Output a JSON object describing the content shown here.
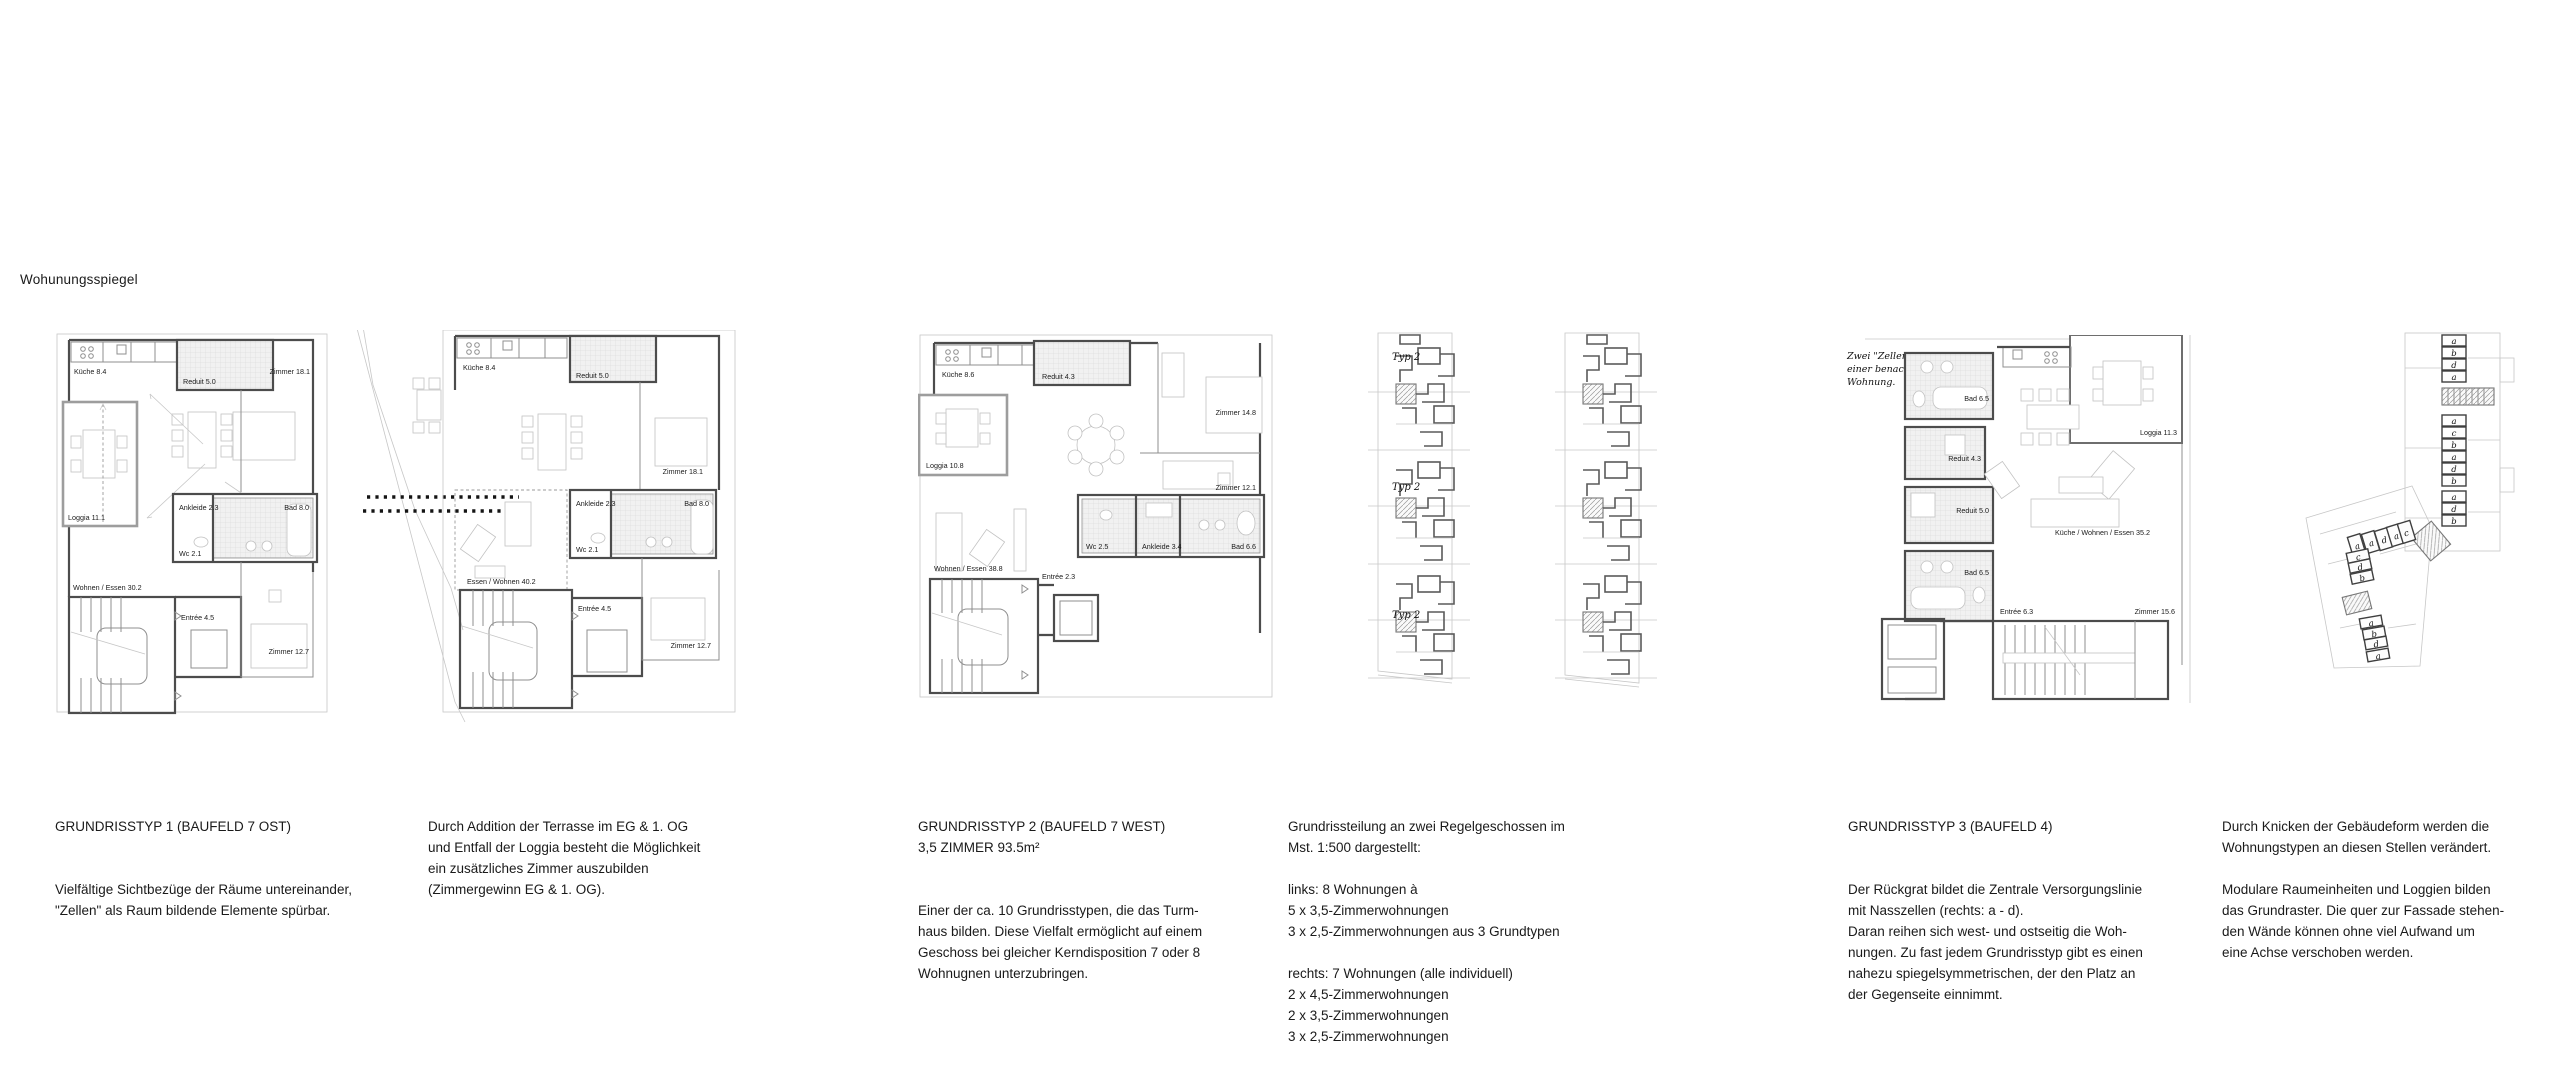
{
  "page": {
    "sheet_label": "Wohunungsspiegel"
  },
  "plans": {
    "plan1": {
      "rooms": {
        "kueche": "Küche 8.4",
        "reduit": "Reduit 5.0",
        "zimmer1": "Zimmer 18.1",
        "loggia": "Loggia 11.1",
        "ankleide": "Ankleide 2.3",
        "bad": "Bad 8.0",
        "wc": "Wc 2.1",
        "wohnen": "Wohnen / Essen 30.2",
        "entree": "Entrée 4.5",
        "zimmer2": "Zimmer 12.7"
      }
    },
    "plan2": {
      "rooms": {
        "kueche": "Küche 8.4",
        "reduit": "Reduit 5.0",
        "zimmer1": "Zimmer 18.1",
        "ankleide": "Ankleide 2.3",
        "bad": "Bad 8.0",
        "wc": "Wc 2.1",
        "wohnen": "Essen / Wohnen 40.2",
        "entree": "Entrée 4.5",
        "zimmer2": "Zimmer 12.7"
      }
    },
    "plan3": {
      "rooms": {
        "kueche": "Küche 8.6",
        "reduit": "Reduit 4.3",
        "zimmer1": "Zimmer 14.8",
        "loggia": "Loggia 10.8",
        "zimmer2": "Zimmer 12.1",
        "wc": "Wc 2.5",
        "ankleide": "Ankleide 3.4",
        "bad": "Bad 6.6",
        "wohnen": "Wohnen / Essen 38.8",
        "entree": "Entrée 2.3"
      }
    },
    "towers": {
      "typ_label": "Typ 2"
    },
    "plan4": {
      "note": "Zwei \"Zellen\"\neiner benachbarten\nWohnung.",
      "rooms": {
        "bad1": "Bad 6.5",
        "reduit1": "Reduit 4.3",
        "reduit2": "Reduit 5.0",
        "loggia": "Loggia 11.3",
        "kueche": "Küche / Wohnen / Essen 35.2",
        "bad2": "Bad 6.5",
        "entree": "Entrée 6.3",
        "zimmer": "Zimmer 15.6"
      }
    },
    "plan5": {
      "cells": [
        "a",
        "b",
        "d",
        "a",
        "a",
        "c",
        "b",
        "a",
        "d",
        "b",
        "a",
        "d",
        "b",
        "a",
        "a",
        "d",
        "a",
        "c",
        "c",
        "d",
        "b",
        "a",
        "b",
        "d",
        "a"
      ]
    }
  },
  "captions": {
    "block1": {
      "title": "GRUNDRISSTYP 1 (BAUFELD 7 OST)",
      "body": "Vielfältige Sichtbezüge der Räume untereinander,\n\"Zellen\" als Raum bildende Elemente spürbar."
    },
    "block2": {
      "title": "",
      "body": "Durch Addition der Terrasse im EG & 1. OG\nund Entfall der Loggia besteht die Möglichkeit\nein zusätzliches Zimmer auszubilden\n(Zimmergewinn EG & 1. OG)."
    },
    "block3": {
      "title": "GRUNDRISSTYP 2 (BAUFELD 7 WEST)\n3,5 ZIMMER 93.5m²",
      "body": "Einer der ca. 10 Grundrisstypen, die das Turm-\nhaus bilden. Diese Vielfalt ermöglicht auf einem\nGeschoss bei gleicher Kerndisposition 7 oder 8\nWohnugnen unterzubringen."
    },
    "block4": {
      "title": "",
      "body": "Grundrissteilung an zwei Regelgeschossen im\nMst. 1:500 dargestellt:\n\nlinks: 8 Wohnungen à\n5 x 3,5-Zimmerwohnungen\n3 x 2,5-Zimmerwohnungen aus 3 Grundtypen\n\nrechts: 7 Wohnungen (alle individuell)\n2 x 4,5-Zimmerwohnungen\n2 x 3,5-Zimmerwohnungen\n3 x 2,5-Zimmerwohnungen"
    },
    "block5": {
      "title": "GRUNDRISSTYP 3 (BAUFELD 4)",
      "body": "Der Rückgrat bildet die Zentrale Versorgungslinie\nmit Nasszellen (rechts: a - d).\nDaran reihen sich west- und ostseitig die Woh-\nnungen. Zu fast jedem Grundrisstyp gibt es einen\nnahezu spiegelsymmetrischen, der den Platz an\nder Gegenseite einnimmt."
    },
    "block6": {
      "title": "",
      "body": "Durch Knicken der Gebäudeform werden die\nWohnungstypen an diesen Stellen verändert.\n\nModulare Raumeinheiten und Loggien bilden\ndas Grundraster. Die quer zur Fassade stehen-\nden Wände können ohne viel Aufwand um\neine Achse verschoben werden."
    }
  }
}
